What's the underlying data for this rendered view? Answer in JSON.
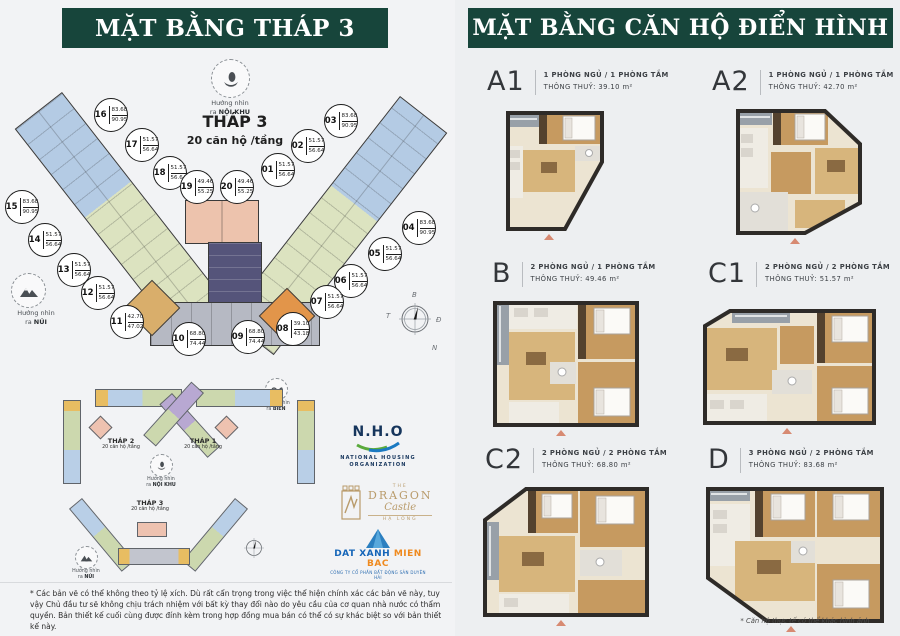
{
  "header_left": {
    "title": "MẶT BẰNG THÁP 3"
  },
  "header_right": {
    "title": "MẶT BẰNG CĂN HỘ ĐIỂN HÌNH"
  },
  "tower": {
    "name": "THÁP 3",
    "subtitle": "20 căn hộ /tầng",
    "views": {
      "noikhu": {
        "line1": "Hướng nhìn",
        "line2": "NỘI KHU",
        "prefix": "ra "
      },
      "nui": {
        "line1": "Hướng nhìn",
        "line2": "NÚI",
        "prefix": "ra "
      },
      "bien": {
        "line1": "Hướng nhìn",
        "line2": "BIỂN",
        "prefix": "ra "
      }
    },
    "units": [
      {
        "no": "01",
        "a": "51.57",
        "b": "56.64"
      },
      {
        "no": "02",
        "a": "51.57",
        "b": "56.64"
      },
      {
        "no": "03",
        "a": "83.68",
        "b": "90.95"
      },
      {
        "no": "04",
        "a": "83.68",
        "b": "90.95"
      },
      {
        "no": "05",
        "a": "51.57",
        "b": "56.64"
      },
      {
        "no": "06",
        "a": "51.57",
        "b": "56.64"
      },
      {
        "no": "07",
        "a": "51.57",
        "b": "56.64"
      },
      {
        "no": "08",
        "a": "39.10",
        "b": "43.18"
      },
      {
        "no": "09",
        "a": "68.80",
        "b": "74.44"
      },
      {
        "no": "10",
        "a": "68.80",
        "b": "74.44"
      },
      {
        "no": "11",
        "a": "42.70",
        "b": "47.02"
      },
      {
        "no": "12",
        "a": "51.57",
        "b": "56.64"
      },
      {
        "no": "13",
        "a": "51.57",
        "b": "56.64"
      },
      {
        "no": "14",
        "a": "51.57",
        "b": "56.64"
      },
      {
        "no": "15",
        "a": "83.68",
        "b": "90.95"
      },
      {
        "no": "16",
        "a": "83.68",
        "b": "90.95"
      },
      {
        "no": "17",
        "a": "51.57",
        "b": "56.64"
      },
      {
        "no": "18",
        "a": "51.57",
        "b": "56.64"
      },
      {
        "no": "19",
        "a": "49.46",
        "b": "55.25"
      },
      {
        "no": "20",
        "a": "49.46",
        "b": "55.25"
      }
    ]
  },
  "compass": {
    "n": "B",
    "w": "T",
    "e": "Đ",
    "s": "N"
  },
  "site_plan": {
    "towers": [
      {
        "name": "THÁP 2",
        "subtitle": "20 căn hộ /tầng"
      },
      {
        "name": "THÁP 1",
        "subtitle": "20 căn hộ /tầng"
      },
      {
        "name": "THÁP 3",
        "subtitle": "20 căn hộ /tầng"
      }
    ]
  },
  "logos": {
    "nho": {
      "name": "N.H.O",
      "line1": "NATIONAL HOUSING",
      "line2": "ORGANIZATION"
    },
    "dragon": {
      "the": "THE",
      "name": "DRAGON",
      "sub": "Castle",
      "location": "HẠ LONG"
    },
    "datxanh": {
      "part1": "DAT XANH",
      "part2": "MIEN BAC",
      "tagline": "CÔNG TY CỔ PHẦN BẤT ĐỘNG SẢN DUYÊN HẢI"
    }
  },
  "disclaimer": "* Các bản vẽ có thể không theo tỷ lệ xích. Dù rất cẩn trọng trong việc thể hiện chính xác các bản vẽ này, tuy vậy Chủ đầu tư sẽ không chịu trách nhiệm với bất kỳ thay đổi nào do yêu cầu của cơ quan nhà nước có thẩm quyền. Bản thiết kế cuối cùng được đính kèm trong hợp đồng mua bán có thể có sự khác biệt so với bản thiết kế này.",
  "apartments": [
    {
      "code": "A1",
      "line1": "1 PHÒNG NGỦ / 1 PHÒNG TẮM",
      "line2": "THÔNG THUỶ: 39.10 m²"
    },
    {
      "code": "A2",
      "line1": "1 PHÒNG NGỦ / 1 PHÒNG TẮM",
      "line2": "THÔNG THUỶ: 42.70 m²"
    },
    {
      "code": "B",
      "line1": "2 PHÒNG NGỦ / 1 PHÒNG TẮM",
      "line2": "THÔNG THUỶ: 49.46 m²"
    },
    {
      "code": "C1",
      "line1": "2 PHÒNG NGỦ / 2 PHÒNG TẮM",
      "line2": "THÔNG THUỶ: 51.57 m²"
    },
    {
      "code": "C2",
      "line1": "2 PHÒNG NGỦ / 2 PHÒNG TẮM",
      "line2": "THÔNG THUỶ: 68.80 m²"
    },
    {
      "code": "D",
      "line1": "3 PHÒNG NGỦ / 2 PHÒNG TẮM",
      "line2": "THÔNG THUỶ: 83.68 m²"
    }
  ],
  "footnote_right": "* Căn hộ thực tế có thể khác hình ảnh"
}
